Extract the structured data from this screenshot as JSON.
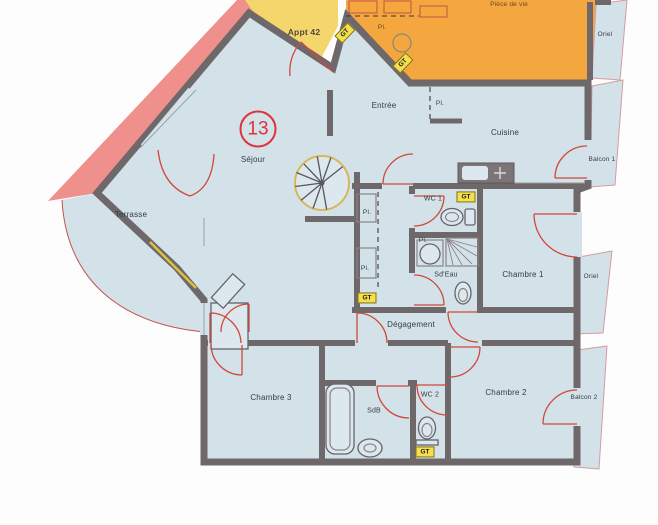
{
  "plan": {
    "type": "scanned-floor-plan",
    "labels": {
      "unit_number": "13",
      "appt42": "Appt 42",
      "piece_de_vie": "Pièce de vie",
      "oriel": "Oriel",
      "entree": "Entrée",
      "cuisine": "Cuisine",
      "balcon1": "Balcon 1",
      "sejour": "Séjour",
      "terrasse": "Terrasse",
      "wc1": "WC 1",
      "sdeau": "Sd'Eau",
      "chambre1": "Chambre 1",
      "degagement": "Dégagement",
      "chambre3": "Chambre 3",
      "sdb": "SdB",
      "wc2": "WC 2",
      "chambre2": "Chambre 2",
      "balcon2": "Balcon 2",
      "placard_abbr": "Pl.",
      "gt": "GT"
    },
    "colors": {
      "wall": "#6f686a",
      "room": "#d3e1e8",
      "room_light": "#dde8ee",
      "orange": "#f3a73e",
      "yellow": "#f5d66d",
      "pink": "#f0908c",
      "door": "#d0483a",
      "gt": "#f4df4e",
      "badge": "#e03238",
      "text": "#353c45"
    }
  }
}
